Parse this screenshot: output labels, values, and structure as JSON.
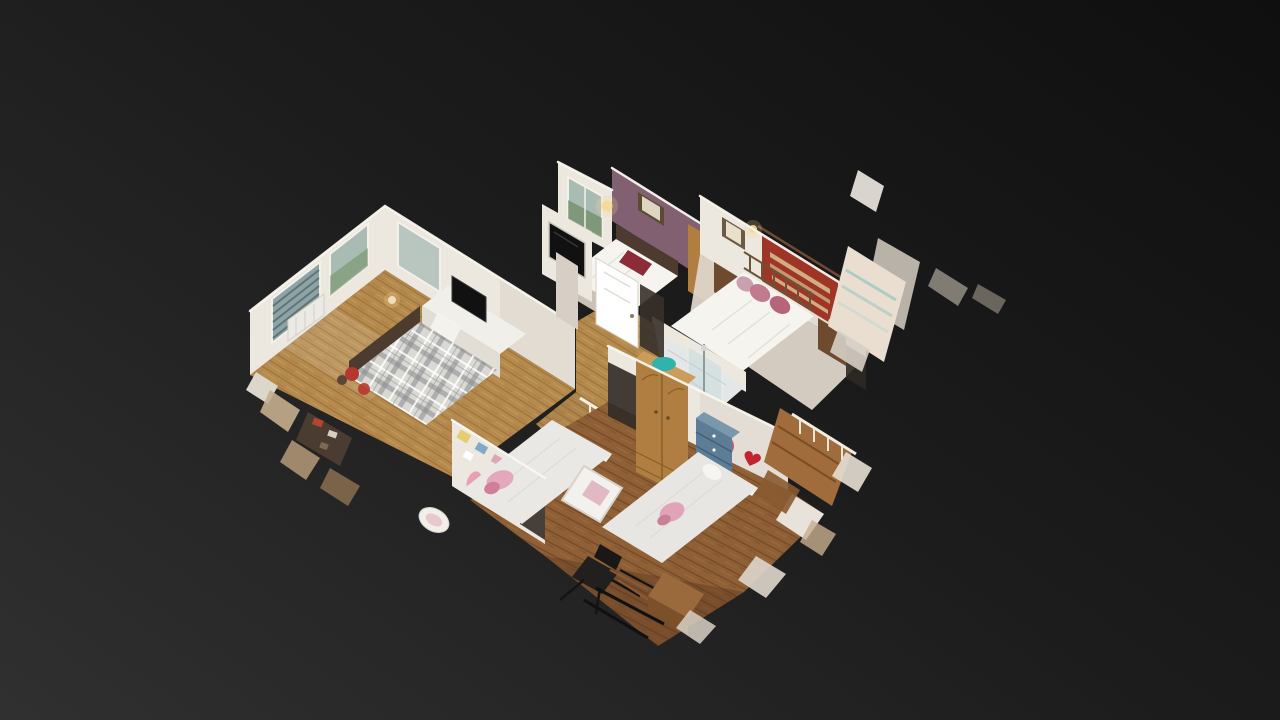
{
  "app": {
    "name": "3D dollhouse viewer",
    "view_label": "Dollhouse cutaway view of a residential upper floor, tilted isometric, floating on a dark studio background"
  },
  "scene": {
    "description": "3D scanned dollhouse model of a home's upper floor seen from above at an angle: four bedrooms, a shower room and a landing, with ragged scan-cut geometry around the edges",
    "rooms": [
      {
        "id": "master-bedroom",
        "label": "Bedroom with plaid double bed, desk, TV and blinded windows"
      },
      {
        "id": "purple-bedroom",
        "label": "Bedroom with plum feature wall, framed picture and white bed"
      },
      {
        "id": "brass-bedroom",
        "label": "Bedroom with brass bed, pink pillows and red wall hanging"
      },
      {
        "id": "landing",
        "label": "Landing and hallway with white doors and wall-mounted TV"
      },
      {
        "id": "shower-room",
        "label": "Shower room with glass enclosure and white fixtures"
      },
      {
        "id": "childrens-bedroom",
        "label": "Children's bedroom with two single beds, crib, pine wardrobe and desk chair"
      }
    ],
    "artifacts": {
      "label": "Scan-cut wall fragments and stair geometry at the model edges"
    },
    "palette": {
      "bgTop": "#0f0f0f",
      "bgMid": "#1c1c1c",
      "bgBottom": "#303030",
      "wall": "#ece7df",
      "wallShade": "#d7cfc5",
      "wallDark": "#bfb5a8",
      "floorOak": "#b58a4e",
      "floorOakDark": "#91672f",
      "floorOakLight": "#cfa868",
      "floorWalnut": "#8f5f36",
      "floorWalnutDark": "#6b4424",
      "floorWalnutLight": "#aa7a48",
      "floorPale": "#ddd5c9",
      "plumWall": "#816071",
      "plaidBase": "#d9d8d2",
      "plaidStripe": "#888c8d",
      "headboard": "#4d3b30",
      "accentRed": "#b5372f",
      "kilimRed": "#9e3526",
      "kilimTrim": "#d9c294",
      "pillowPink": "#c27a8e",
      "pine": "#b07e40",
      "pineDark": "#8a5f2a",
      "pineLight": "#c99d5c",
      "drawerBlue": "#5c7d95",
      "drawerBlueDark": "#42607a",
      "teal": "#2fb3ab",
      "heartRed": "#c2232e",
      "tvBlack": "#111111",
      "glass": "#8da4a6",
      "glassLight": "#a9bcb4",
      "blind": "#5c6e70",
      "glow": "#f7d893",
      "whiteSoft": "#f6f4ef",
      "junkTan": "#c7ae8e",
      "junkBrown": "#7c5c3d",
      "posterYellow": "#e5ce6e",
      "posterBlue": "#7fa8c9",
      "posterPink": "#dba6b6"
    }
  }
}
